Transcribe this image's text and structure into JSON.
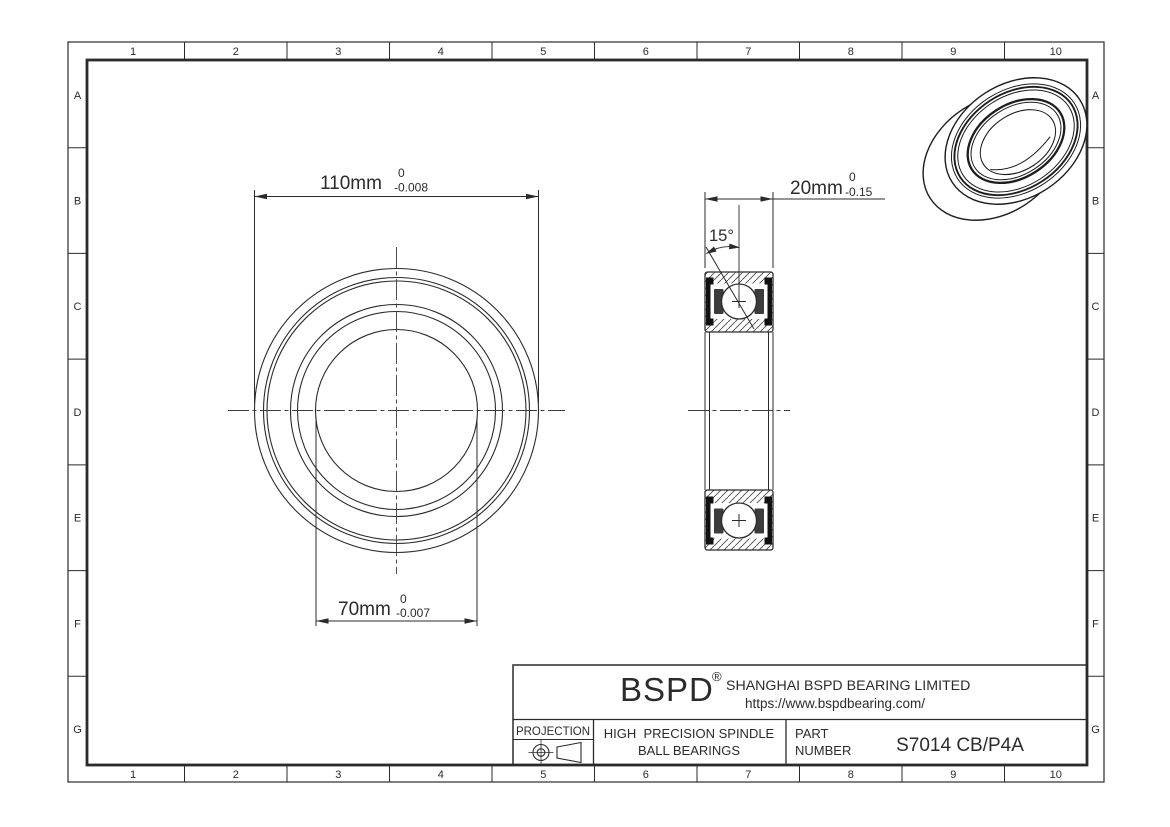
{
  "frame": {
    "columns": [
      "1",
      "2",
      "3",
      "4",
      "5",
      "6",
      "7",
      "8",
      "9",
      "10"
    ],
    "rows": [
      "A",
      "B",
      "C",
      "D",
      "E",
      "F",
      "G"
    ]
  },
  "front_view": {
    "od_dim": {
      "value": "110mm",
      "tol_upper": "0",
      "tol_lower": "-0.008"
    },
    "bore_dim": {
      "value": "70mm",
      "tol_upper": "0",
      "tol_lower": "-0.007"
    }
  },
  "side_view": {
    "width_dim": {
      "value": "20mm",
      "tol_upper": "0",
      "tol_lower": "-0.15"
    },
    "contact_angle": "15°"
  },
  "title_block": {
    "logo": "BSPD",
    "logo_reg": "®",
    "company": "SHANGHAI BSPD BEARING LIMITED",
    "website": "https://www.bspdbearing.com/",
    "projection_label": "PROJECTION",
    "product_line1": "HIGH  PRECISION SPINDLE",
    "product_line2": "BALL BEARINGS",
    "part_label1": "PART",
    "part_label2": "NUMBER",
    "part_number": "S7014 CB/P4A"
  },
  "colors": {
    "line": "#2b2b2b",
    "background": "#ffffff"
  }
}
